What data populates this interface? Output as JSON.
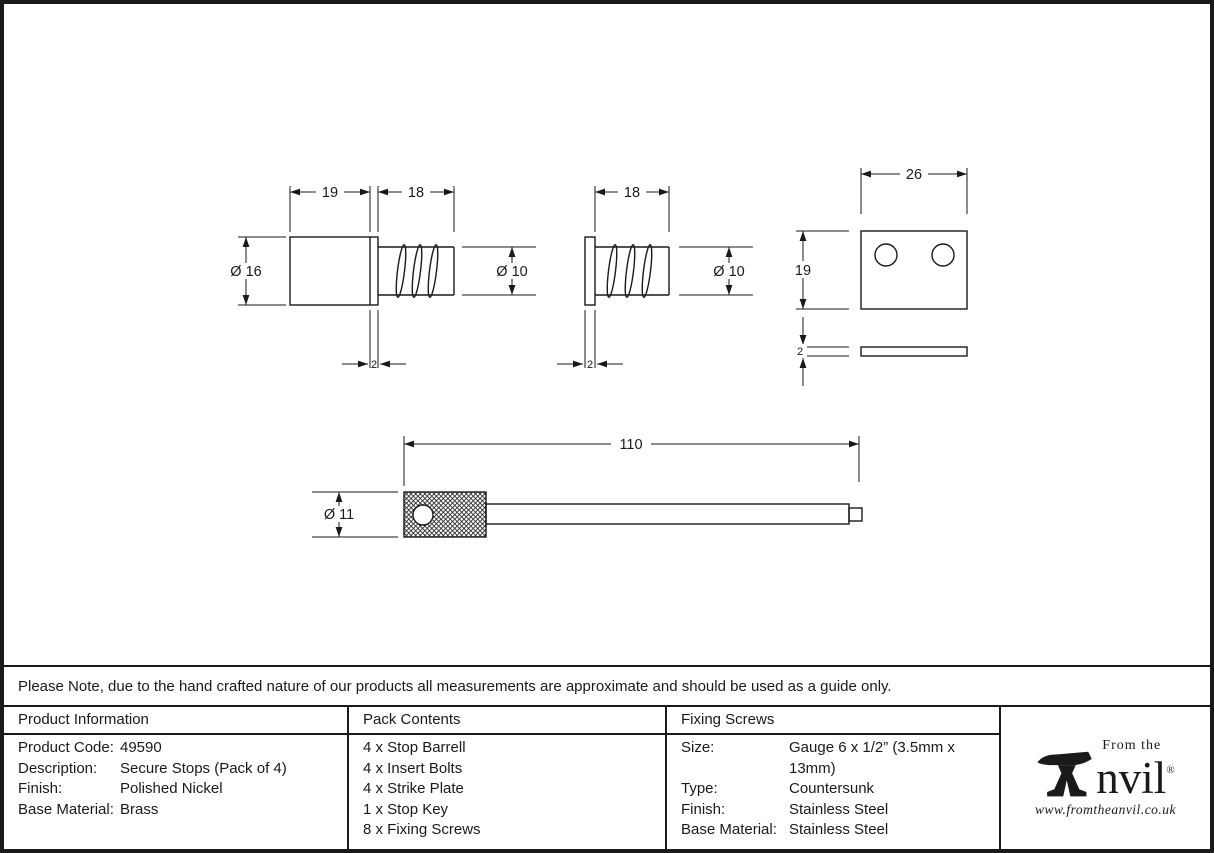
{
  "colors": {
    "ink": "#1a1a1a",
    "paper": "#ffffff"
  },
  "note": {
    "text": "Please Note, due to the hand crafted nature of our products all measurements are approximate and should be used as a guide only."
  },
  "drawings": {
    "stop_barrel": {
      "length_body": "19",
      "length_thread": "18",
      "dia_body": "Ø 16",
      "dia_thread": "Ø 10",
      "flange_thickness": "2"
    },
    "insert_bolt": {
      "length_thread": "18",
      "dia_thread": "Ø 10",
      "flange_thickness": "2"
    },
    "strike_plate": {
      "width": "26",
      "height": "19",
      "thickness": "2"
    },
    "stop_key": {
      "length": "110",
      "dia_head": "Ø 11"
    }
  },
  "product_information": {
    "header": "Product Information",
    "rows": [
      {
        "label": "Product Code:",
        "value": "49590"
      },
      {
        "label": "Description:",
        "value": "Secure Stops (Pack of 4)"
      },
      {
        "label": "Finish:",
        "value": "Polished Nickel"
      },
      {
        "label": "Base Material:",
        "value": "Brass"
      }
    ]
  },
  "pack_contents": {
    "header": "Pack Contents",
    "items": [
      "4 x Stop Barrell",
      "4 x Insert Bolts",
      "4 x Strike Plate",
      "1 x Stop Key",
      "8 x Fixing Screws"
    ]
  },
  "fixing_screws": {
    "header": "Fixing Screws",
    "rows": [
      {
        "label": "Size:",
        "value": "Gauge 6 x 1/2” (3.5mm x 13mm)"
      },
      {
        "label": "Type:",
        "value": "Countersunk"
      },
      {
        "label": "Finish:",
        "value": "Stainless Steel"
      },
      {
        "label": "Base Material:",
        "value": "Brass"
      }
    ]
  },
  "fixing_screws_fix": {
    "base_material_value": "Stainless Steel"
  },
  "logo": {
    "from_the": "From the",
    "brand": "nvil",
    "registered": "®",
    "website": "www.fromtheanvil.co.uk"
  }
}
